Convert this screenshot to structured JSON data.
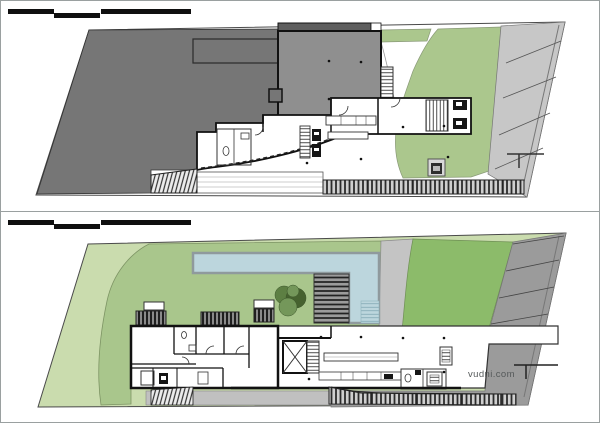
{
  "watermark": {
    "text": "vudni.com",
    "color": "#55595a"
  },
  "scale_bar": {
    "segments": 3,
    "color": "#0f0f0f"
  },
  "colors": {
    "page_border": "#9aa0a0",
    "boundary_line": "#4a4a4a",
    "wall": "#111111",
    "hill": "#767676",
    "roof": "#8f8f8f",
    "roof_strip": "#5e5e5e",
    "lawn_top": "#abc78d",
    "parking_top": "#c7c7c7",
    "pad_gray": "#d8d8d8",
    "pale_green": "#cadcae",
    "lawn_mid": "#a9c68c",
    "lawn_vivid": "#8cbb6a",
    "pool_blue": "#bcd6dd",
    "pool_wall": "#8f9a9d",
    "path_gray": "#c4c4c4",
    "driveway": "#9b9b9b",
    "slab_gray": "#c0c0c0",
    "tree_dark": "#46622f",
    "tree_mid": "#5d7f43",
    "tree_light": "#74975a"
  },
  "plans": [
    {
      "id": "upper-level-plan",
      "features": [
        "scale-bar",
        "site-boundary",
        "hillside",
        "building-roof",
        "lower-floor-rooms",
        "stairs",
        "lawn",
        "entry-path",
        "parking-area",
        "fence",
        "ramp",
        "utility-pad"
      ]
    },
    {
      "id": "lower-level-plan",
      "features": [
        "scale-bar",
        "site-boundary",
        "lawn",
        "swimming-pool",
        "pool-stairs",
        "garden-path",
        "tree",
        "bedroom-wing",
        "terrace",
        "elevator",
        "outdoor-kitchen",
        "parking-area",
        "fence",
        "ramp",
        "watermark"
      ]
    }
  ]
}
